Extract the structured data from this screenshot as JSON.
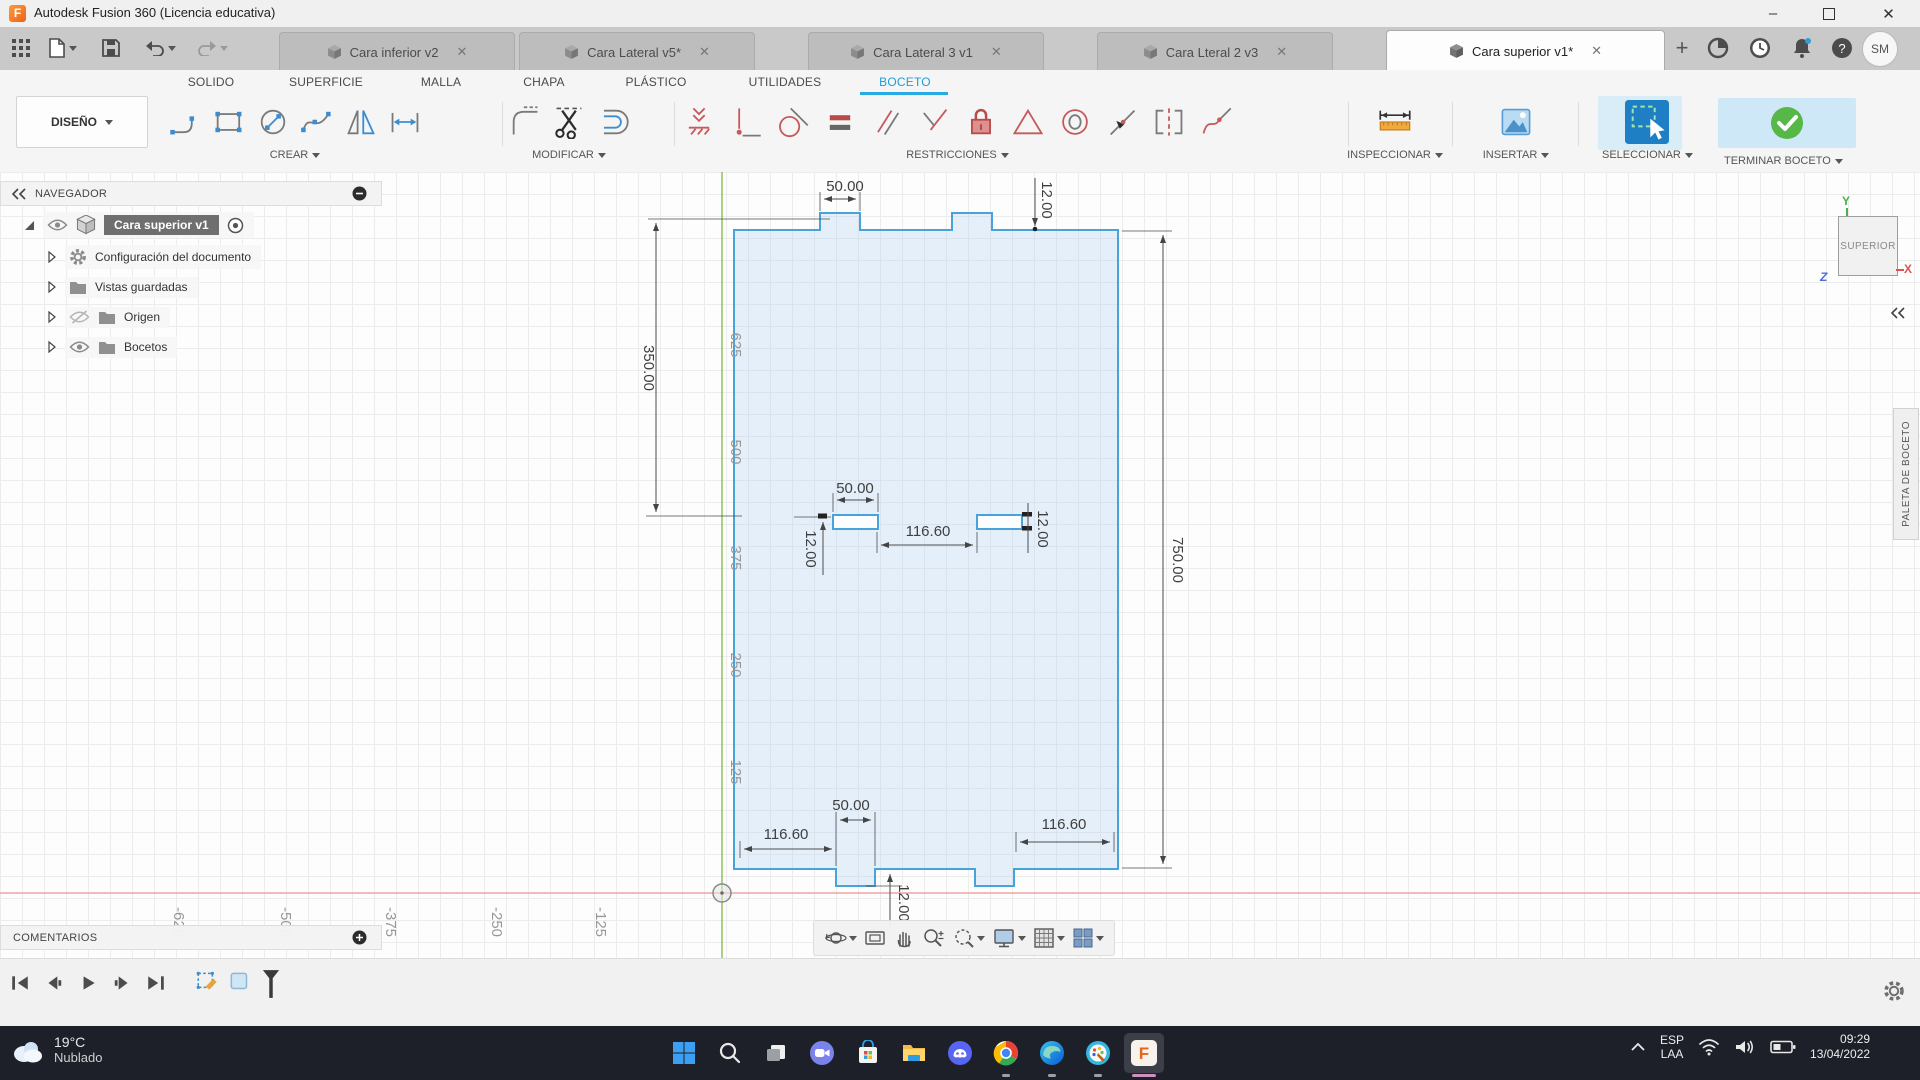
{
  "window": {
    "title": "Autodesk Fusion 360 (Licencia educativa)"
  },
  "tab_bar": {
    "tabs": [
      {
        "label": "Cara inferior v2",
        "active": false
      },
      {
        "label": "Cara Lateral v5*",
        "active": false
      },
      {
        "label": "Cara Lateral 3 v1",
        "active": false
      },
      {
        "label": "Cara Lteral 2 v3",
        "active": false
      },
      {
        "label": "Cara superior v1*",
        "active": true
      }
    ],
    "new_tab": "+",
    "help_glyph": "?",
    "avatar": "SM"
  },
  "ribbon": {
    "design_label": "DISEÑO",
    "workspace_tabs": [
      "SOLIDO",
      "SUPERFICIE",
      "MALLA",
      "CHAPA",
      "PLÁSTICO",
      "UTILIDADES",
      "BOCETO"
    ],
    "active_workspace_tab": "BOCETO",
    "groups": [
      {
        "label": "CREAR"
      },
      {
        "label": "MODIFICAR"
      },
      {
        "label": "RESTRICCIONES"
      },
      {
        "label": "INSPECCIONAR"
      },
      {
        "label": "INSERTAR"
      },
      {
        "label": "SELECCIONAR"
      },
      {
        "label": "TERMINAR BOCETO"
      }
    ]
  },
  "navigator": {
    "header": "NAVEGADOR",
    "items": [
      {
        "label": "Cara superior v1",
        "selected": true,
        "visible": true
      },
      {
        "label": "Configuración del documento"
      },
      {
        "label": "Vistas guardadas"
      },
      {
        "label": "Origen",
        "visible": false
      },
      {
        "label": "Bocetos",
        "visible": true
      }
    ]
  },
  "comments": {
    "label": "COMENTARIOS"
  },
  "sketch_palette": {
    "label": "PALETA DE BOCETO"
  },
  "viewcube": {
    "face": "SUPERIOR",
    "axis_x": "X",
    "axis_y": "Y",
    "axis_z": "Z"
  },
  "sketch": {
    "dimensions": [
      {
        "name": "top-tab-width",
        "value": "50.00"
      },
      {
        "name": "top-tab-depth",
        "value": "12.00"
      },
      {
        "name": "upper-height",
        "value": "350.00"
      },
      {
        "name": "total-height",
        "value": "750.00"
      },
      {
        "name": "slot-width",
        "value": "50.00"
      },
      {
        "name": "slot-gap",
        "value": "116.60"
      },
      {
        "name": "slot-height-left",
        "value": "12.00"
      },
      {
        "name": "slot-height-right",
        "value": "12.00"
      },
      {
        "name": "bottom-tab-width",
        "value": "50.00"
      },
      {
        "name": "bottom-left-offset",
        "value": "116.60"
      },
      {
        "name": "bottom-right-offset",
        "value": "116.60"
      },
      {
        "name": "bottom-tab-depth",
        "value": "12.00"
      }
    ],
    "y_axis_labels": [
      "625",
      "500",
      "375",
      "250",
      "125"
    ],
    "x_axis_labels": [
      "-625",
      "-500",
      "-375",
      "-250",
      "-125"
    ]
  },
  "taskbar": {
    "weather": {
      "temp": "19°C",
      "condition": "Nublado"
    },
    "tray": {
      "lang_line1": "ESP",
      "lang_line2": "LAA",
      "time": "09:29",
      "date": "13/04/2022"
    }
  },
  "colors": {
    "accent_blue": "#29abe2",
    "sketch_line": "#47a3da",
    "constraint_red": "#c65959",
    "finish_green": "#57b847",
    "axis_x_red": "#f0a3a3",
    "axis_y_green": "#7cb93e"
  }
}
